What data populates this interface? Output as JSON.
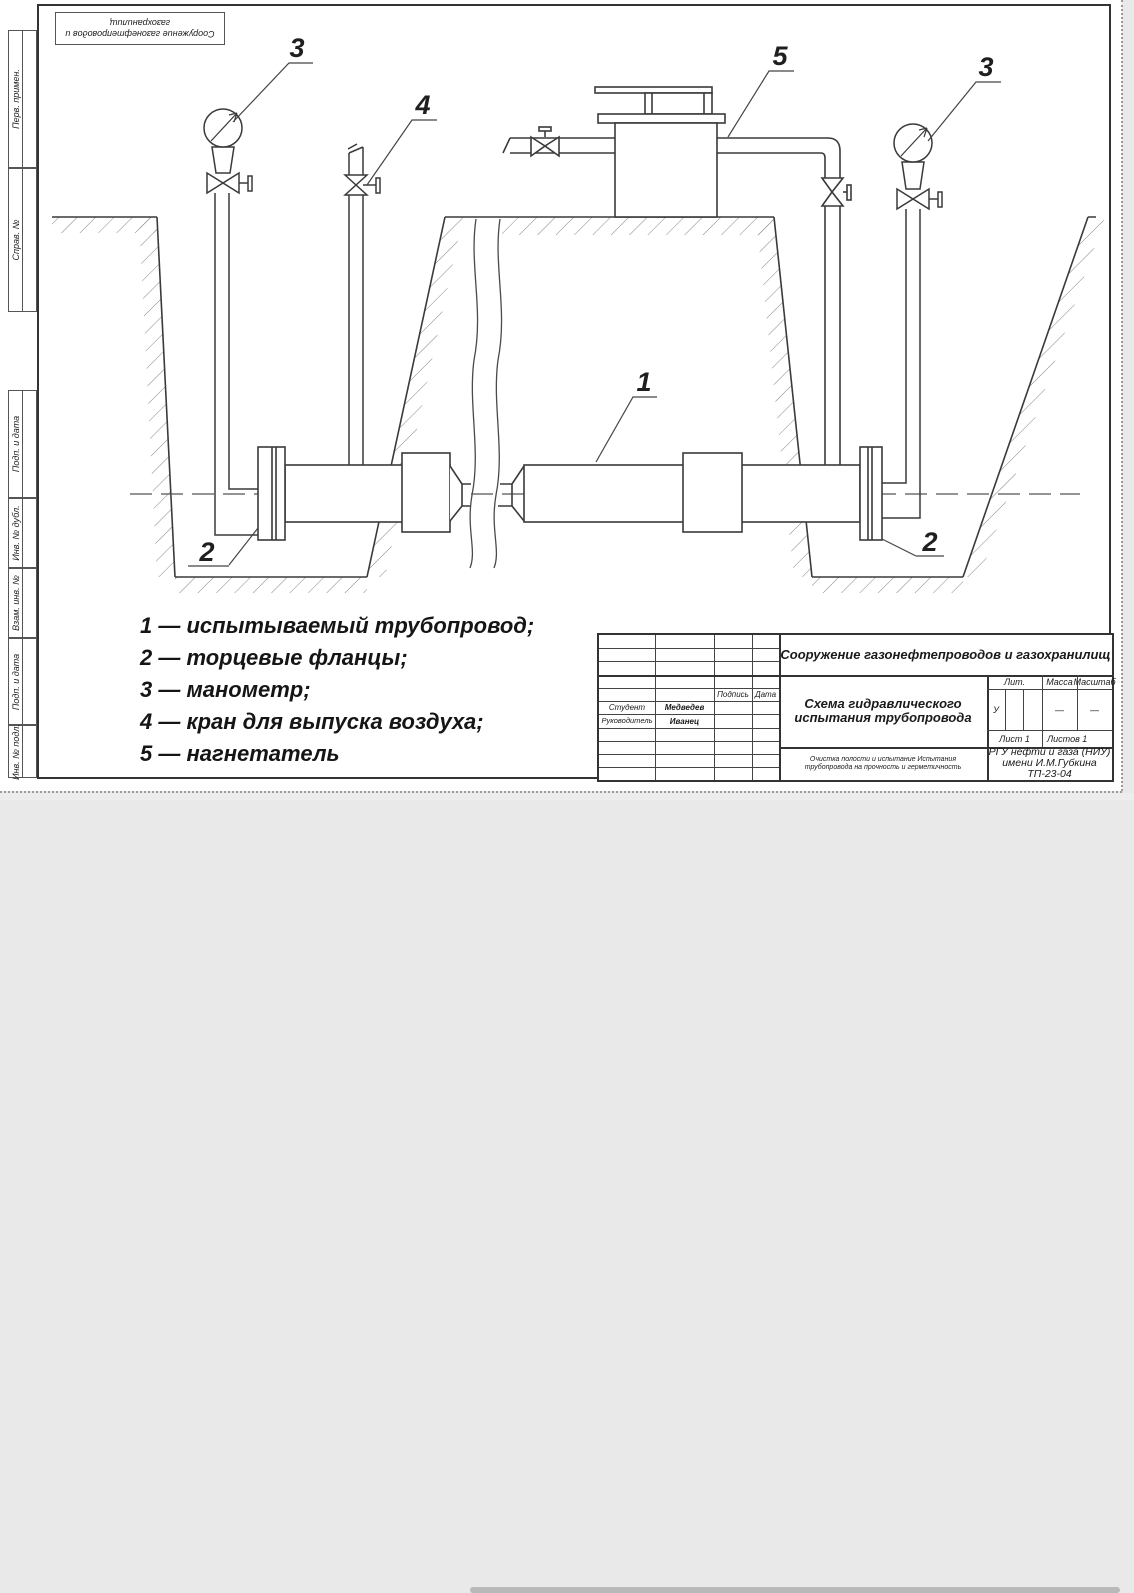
{
  "stamp_top_left": {
    "text": "Сооружение газонефтепроводов и газохранилищ"
  },
  "margin_labels": [
    {
      "label": "Перв. примен."
    },
    {
      "label": "Справ. №"
    },
    {
      "label": "Подп. и дата"
    },
    {
      "label": "Инв. № дубл."
    },
    {
      "label": "Взам. инв. №"
    },
    {
      "label": "Подп. и дата"
    },
    {
      "label": "Инв. № подл."
    }
  ],
  "callouts": {
    "pipe": "1",
    "flange_left": "2",
    "flange_right": "2",
    "gauge_left": "3",
    "gauge_right": "3",
    "air_valve": "4",
    "compressor": "5"
  },
  "legend": {
    "items": [
      {
        "text": "1 — испытываемый трубопровод;"
      },
      {
        "text": "2 — торцевые фланцы;"
      },
      {
        "text": "3 — манометр;"
      },
      {
        "text": "4 — кран для выпуска воздуха;"
      },
      {
        "text": "5 — нагнетатель"
      }
    ]
  },
  "title_block": {
    "course": "Сооружение газонефтепроводов и газохранилищ",
    "title_line1": "Схема гидравлического",
    "title_line2": "испытания трубопровода",
    "header_sign": "Подпись",
    "header_date": "Дата",
    "roles": [
      {
        "role": "Студент",
        "name": "Медведев"
      },
      {
        "role": "Руководитель",
        "name": "Иванец"
      }
    ],
    "lit_label": "Лит.",
    "lit_value": "У",
    "mass_label": "Масса",
    "mass_value": "—",
    "scale_label": "Масштаб",
    "scale_value": "—",
    "sheet": "Лист 1",
    "sheets": "Листов 1",
    "note_line1": "Очистка полости и испытание Испытания",
    "note_line2": "трубопровода на прочность и герметичность",
    "org_line1": "РГУ нефти и газа (НИУ)",
    "org_line2": "имени И.М.Губкина",
    "org_line3": "ТП-23-04"
  }
}
